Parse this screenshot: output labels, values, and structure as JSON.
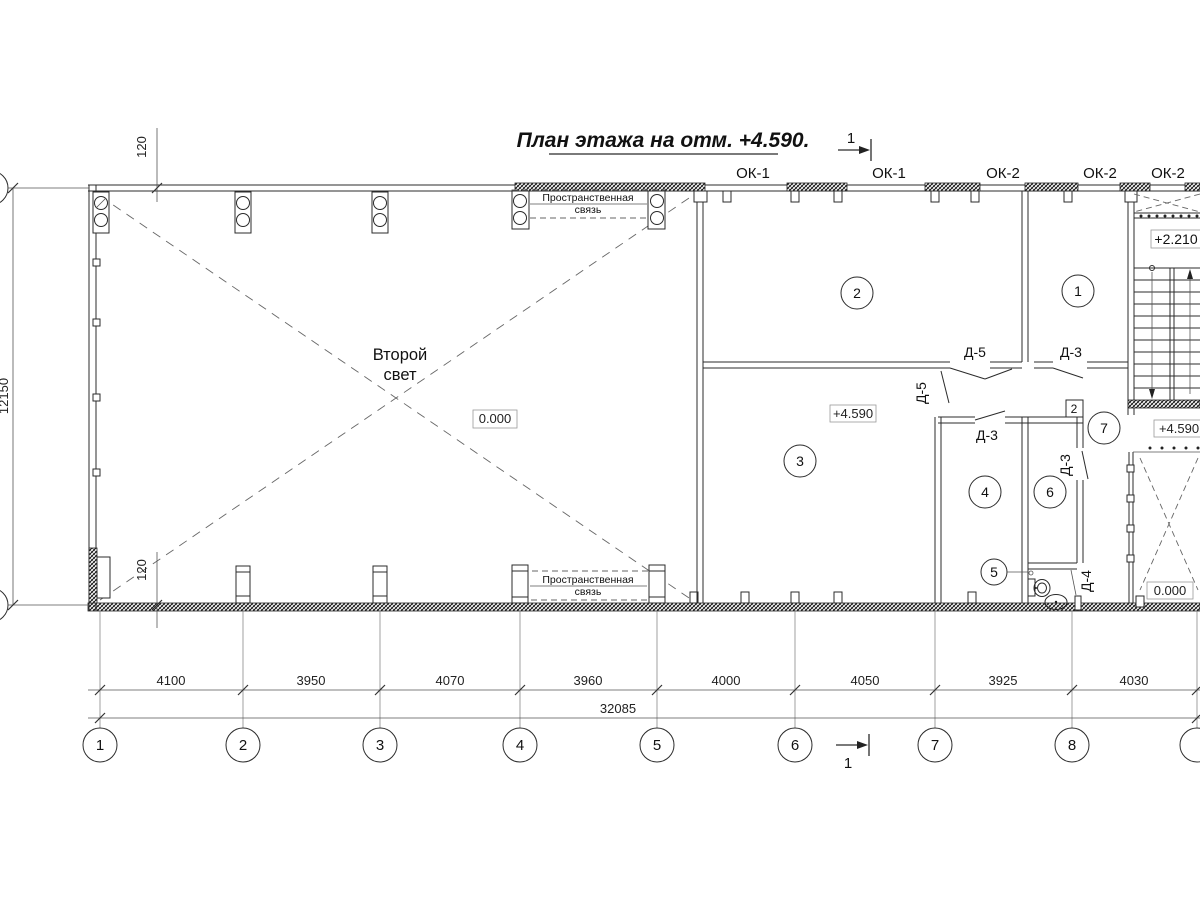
{
  "title": "План этажа на отм. +4.590.",
  "hall": {
    "label1": "Второй",
    "label2": "свет",
    "level": "0.000"
  },
  "braces": {
    "top1": "Пространственная",
    "top2": "связь",
    "bottom1": "Пространственная",
    "bottom2": "связь"
  },
  "windows": {
    "w1": "ОК-1",
    "w2": "ОК-1",
    "w3": "ОК-2",
    "w4": "ОК-2",
    "w5": "ОК-2"
  },
  "doors": {
    "d5a": "Д-5",
    "d5b": "Д-5",
    "d3a": "Д-3",
    "d3b": "Д-3",
    "d3c": "Д-3",
    "d4": "Д-4"
  },
  "rooms": {
    "r1": "1",
    "r2": "2",
    "r3": "3",
    "r4": "4",
    "r5": "5",
    "r6": "6",
    "r7": "7"
  },
  "levels": {
    "mezzanine": "+4.590",
    "stair_landing": "+2.210",
    "stair_exit": "+4.590",
    "void": "0.000"
  },
  "node_marker": "2",
  "section": {
    "top": "1",
    "bottom": "1"
  },
  "dimensions": {
    "spans": [
      "4100",
      "3950",
      "4070",
      "3960",
      "4000",
      "4050",
      "3925",
      "4030"
    ],
    "total": "32085",
    "height": "12150",
    "wall_offset_top": "120",
    "wall_offset_bottom": "120"
  },
  "grid_bubbles": [
    "1",
    "2",
    "3",
    "4",
    "5",
    "6",
    "7",
    "8"
  ]
}
